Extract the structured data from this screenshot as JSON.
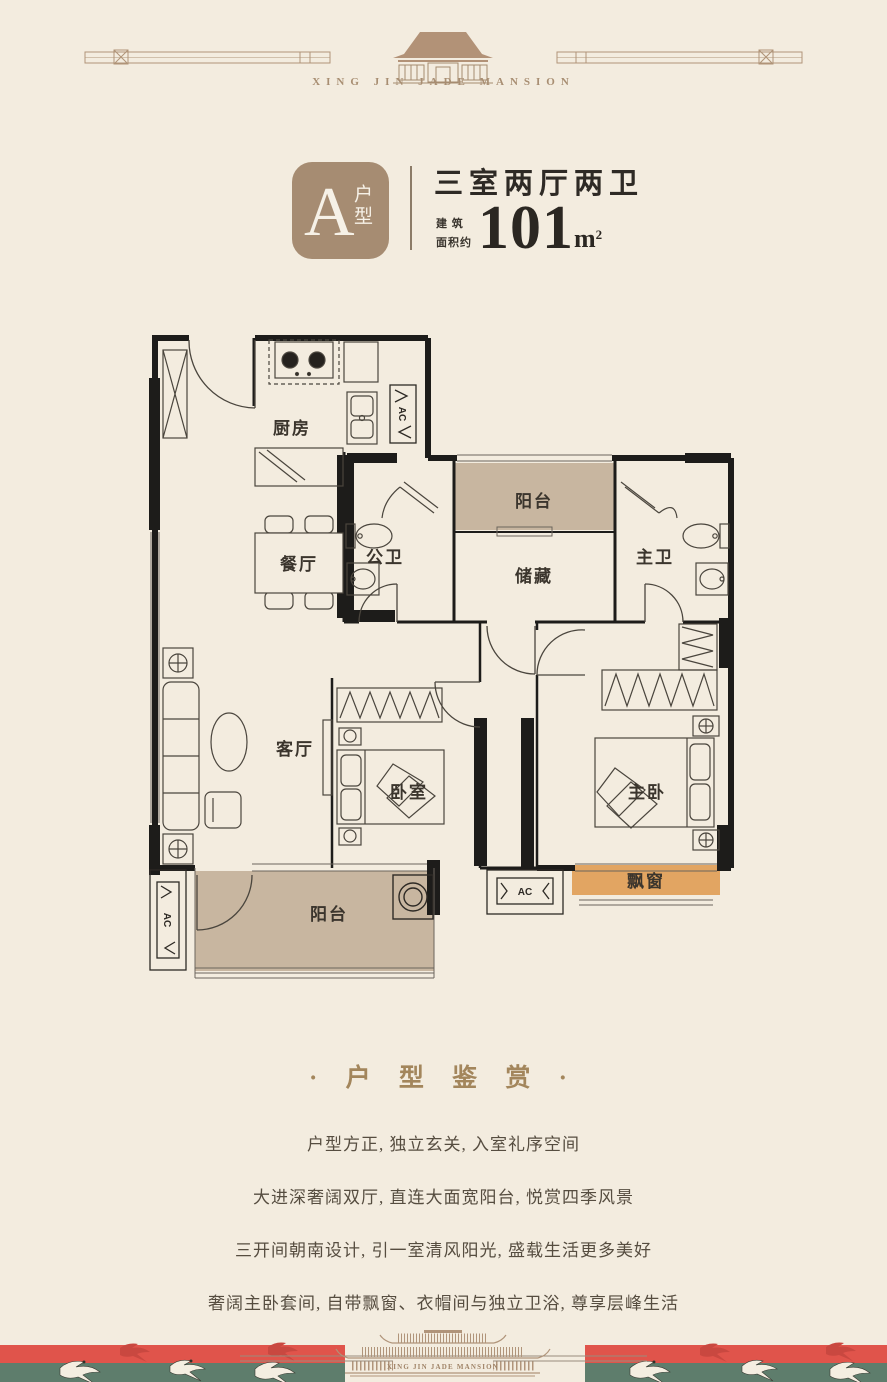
{
  "header": {
    "brand_en": "XING JIN JADE MANSION"
  },
  "unit": {
    "badge_letter": "A",
    "badge_suffix": "户型",
    "layout_title": "三室两厅两卫",
    "area_label_line1": "建 筑",
    "area_label_line2": "面积约",
    "area_number": "101",
    "area_unit_base": "m",
    "area_unit_exp": "2"
  },
  "floorplan": {
    "ac_label": "AC",
    "rooms": {
      "kitchen": "厨房",
      "dining": "餐厅",
      "guest_bath": "公卫",
      "service_balcony": "阳台",
      "storage": "储藏",
      "master_bath": "主卫",
      "living": "客厅",
      "bedroom": "卧室",
      "master_bedroom": "主卧",
      "balcony": "阳台",
      "bay_window": "飘窗"
    }
  },
  "appreciation": {
    "title": "· 户 型 鉴 赏 ·",
    "lines": [
      "户型方正, 独立玄关, 入室礼序空间",
      "大进深奢阔双厅, 直连大面宽阳台, 悦赏四季风景",
      "三开间朝南设计, 引一室清风阳光, 盛载生活更多美好",
      "奢阔主卧套间, 自带飘窗、衣帽间与独立卫浴, 尊享层峰生活"
    ]
  },
  "footer": {
    "brand_en": "XING JIN JADE MANSION"
  },
  "colors": {
    "background": "#f3ecdf",
    "badge": "#a68c72",
    "accent_gold": "#a3865c",
    "wall": "#1d1c1a",
    "balcony_fill": "#c8b6a0",
    "bay_window_fill": "#e2a562",
    "band_red": "#e0544b",
    "band_green": "#5e7d6c"
  }
}
